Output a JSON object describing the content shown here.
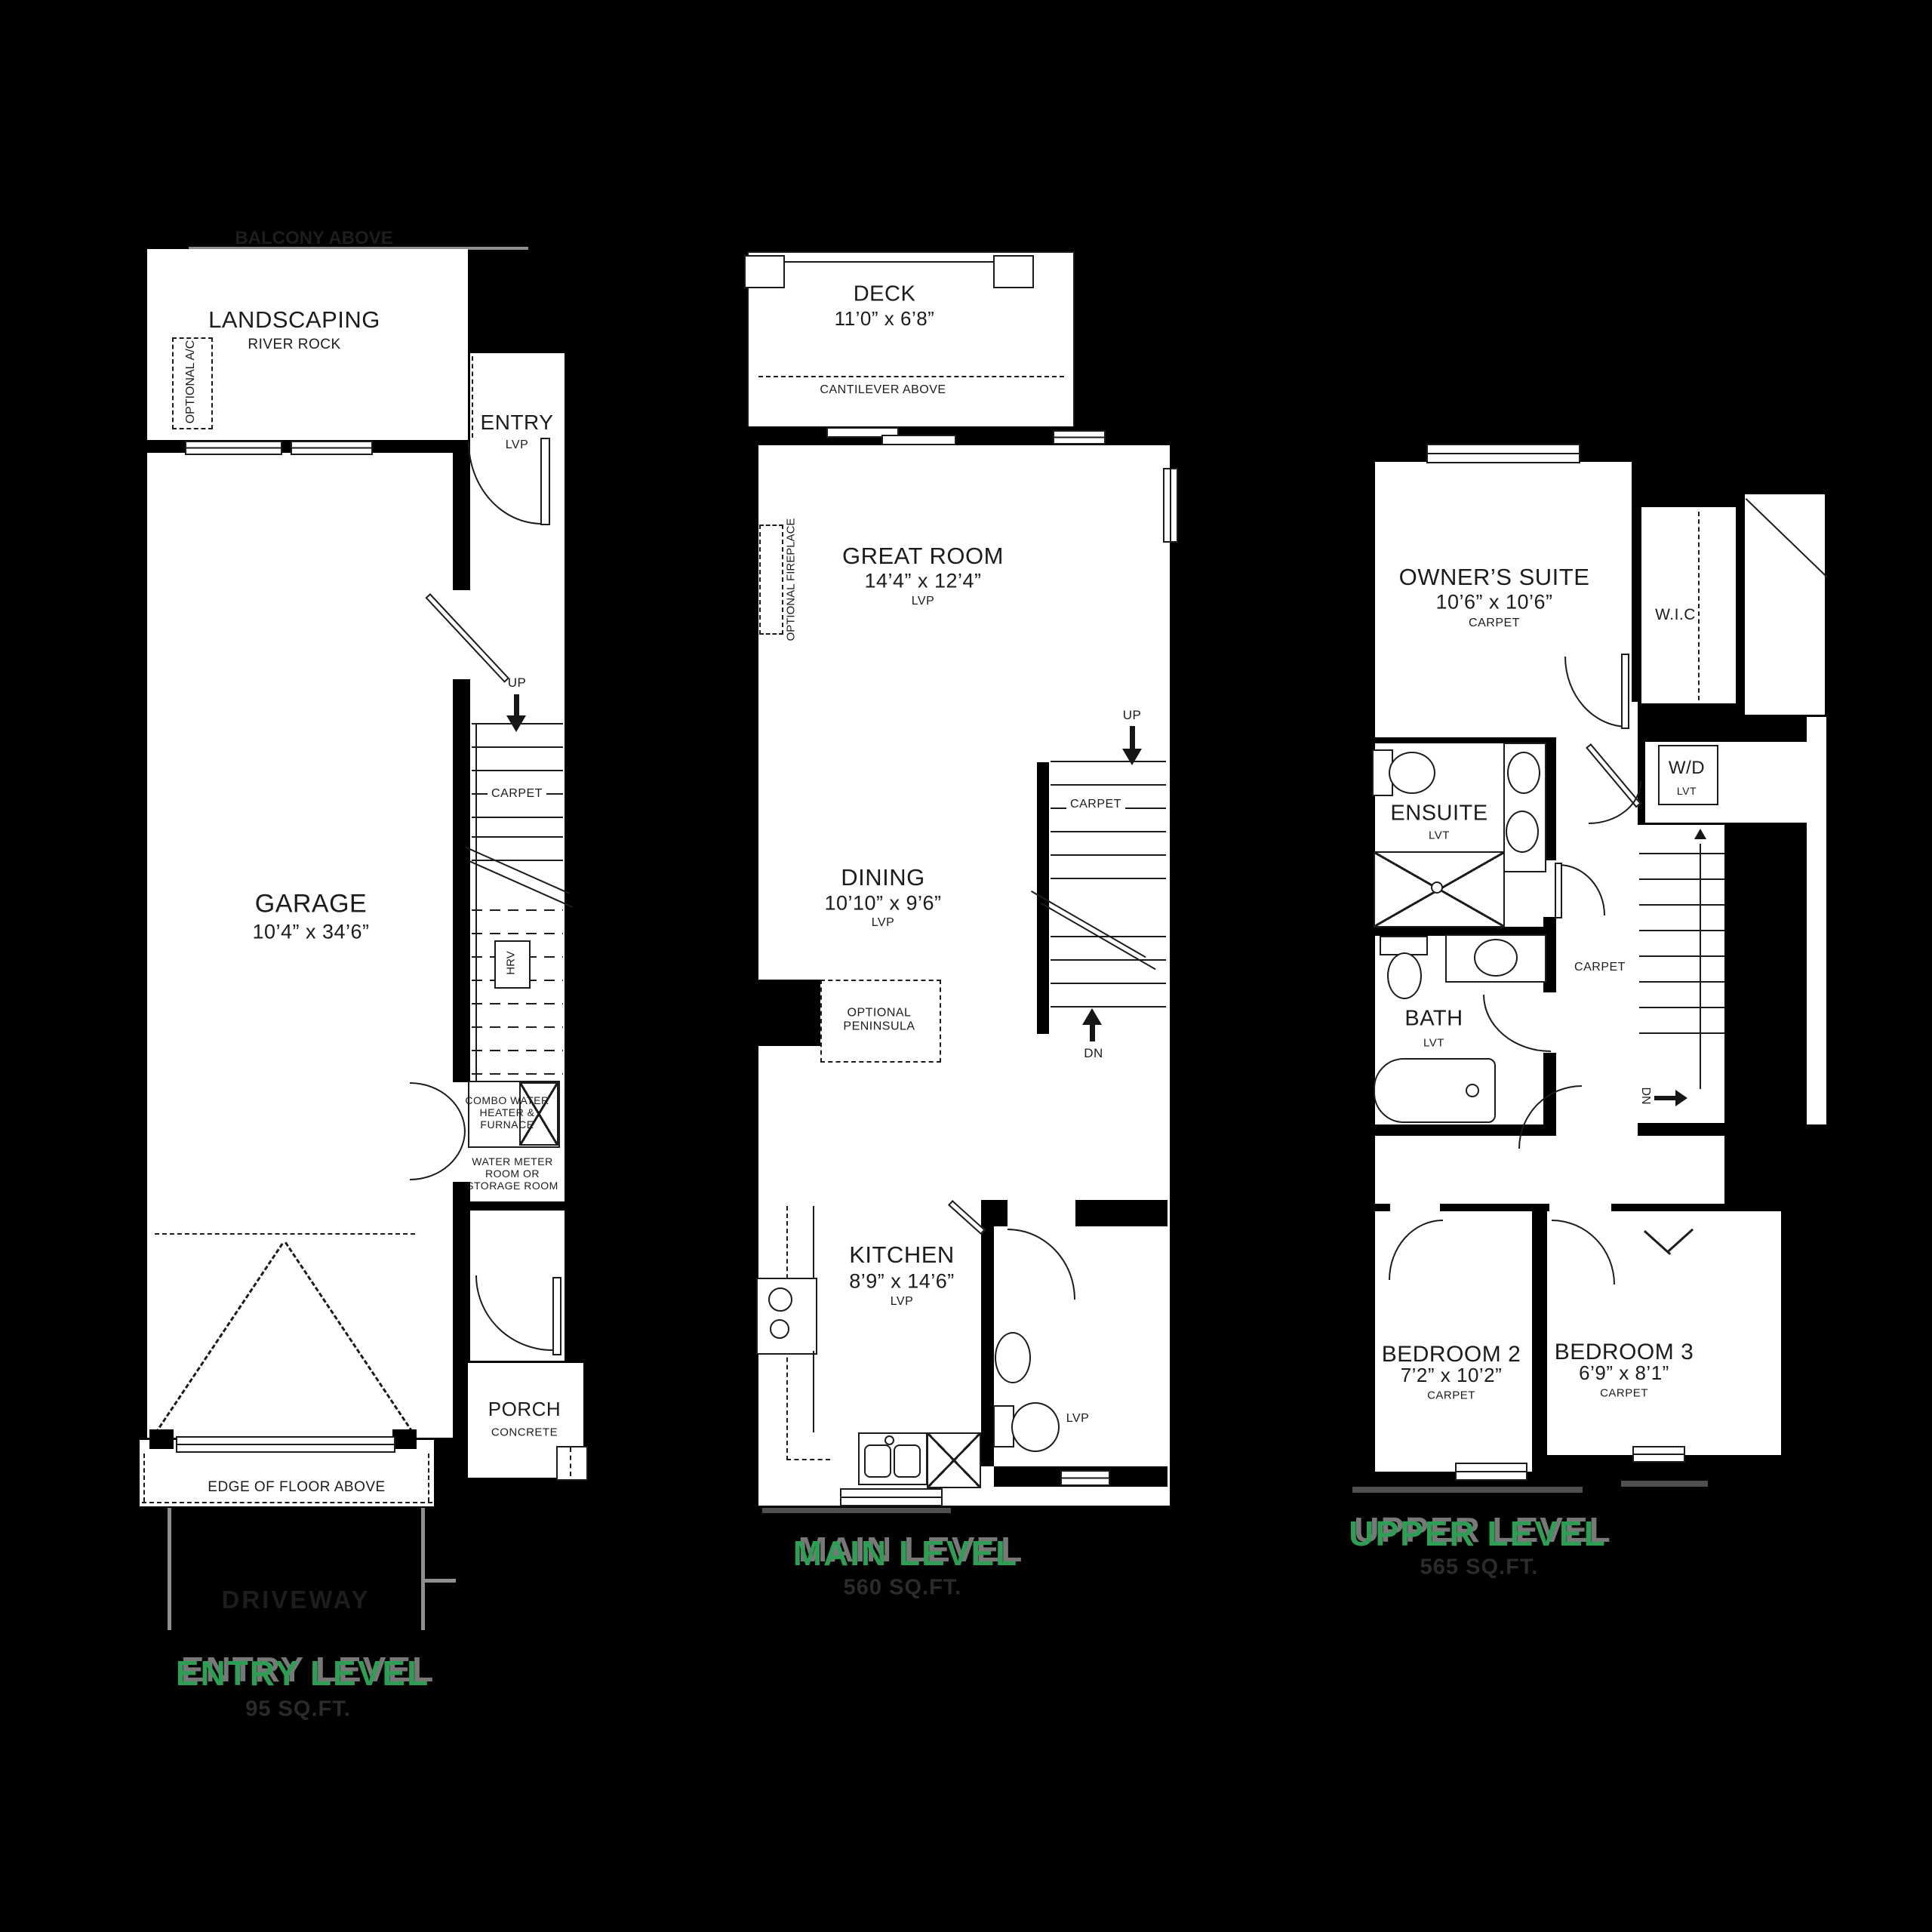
{
  "palette": {
    "bg": "#000000",
    "paper": "#ffffff",
    "line": "#1c1c1c",
    "green": "#2f9e55",
    "heading_shadow": "#787878",
    "faded_text": "#1d1d1d",
    "sqft_text": "#2b2b2b",
    "gray": "#8f8f8f"
  },
  "levels": {
    "entry": {
      "heading": "ENTRY LEVEL",
      "sqft": "95 SQ.FT.",
      "balcony": "BALCONY ABOVE",
      "driveway": "DRIVEWAY",
      "landscaping": "LANDSCAPING",
      "river_rock": "RIVER ROCK",
      "optional_ac": "OPTIONAL A/C",
      "entry": "ENTRY",
      "entry_floor": "LVP",
      "up": "UP",
      "stairs_floor": "CARPET",
      "hrv": "HRV",
      "garage": "GARAGE",
      "garage_dims": "10’4” x 34’6”",
      "combo": "COMBO WATER\nHEATER &\nFURNACE",
      "water_meter": "WATER METER\nROOM OR\nSTORAGE ROOM",
      "porch": "PORCH",
      "porch_floor": "CONCRETE",
      "edge": "EDGE OF FLOOR ABOVE"
    },
    "main": {
      "heading": "MAIN LEVEL",
      "sqft": "560 SQ.FT.",
      "deck": "DECK",
      "deck_dims": "11’0” x 6’8”",
      "cantilever": "CANTILEVER ABOVE",
      "great": "GREAT ROOM",
      "great_dims": "14’4” x 12’4”",
      "great_floor": "LVP",
      "optional_fireplace": "OPTIONAL FIREPLACE",
      "up": "UP",
      "stairs_floor": "CARPET",
      "dn": "DN",
      "dining": "DINING",
      "dining_dims": "10’10” x 9’6”",
      "dining_floor": "LVP",
      "peninsula": "OPTIONAL\nPENINSULA",
      "kitchen": "KITCHEN",
      "kitchen_dims": "8’9” x 14’6”",
      "kitchen_floor": "LVP",
      "powder_floor": "LVP"
    },
    "upper": {
      "heading": "UPPER LEVEL",
      "sqft": "565 SQ.FT.",
      "owners": "OWNER’S SUITE",
      "owners_dims": "10’6” x 10’6”",
      "owners_floor": "CARPET",
      "wic": "W.I.C",
      "wd": "W/D",
      "wd_floor": "LVT",
      "ensuite": "ENSUITE",
      "ensuite_floor": "LVT",
      "bath": "BATH",
      "bath_floor": "LVT",
      "hall_floor": "CARPET",
      "dn": "DN",
      "bed2": "BEDROOM 2",
      "bed2_dims": "7’2” x 10’2”",
      "bed2_floor": "CARPET",
      "bed3": "BEDROOM 3",
      "bed3_dims": "6’9” x 8’1”",
      "bed3_floor": "CARPET"
    }
  }
}
